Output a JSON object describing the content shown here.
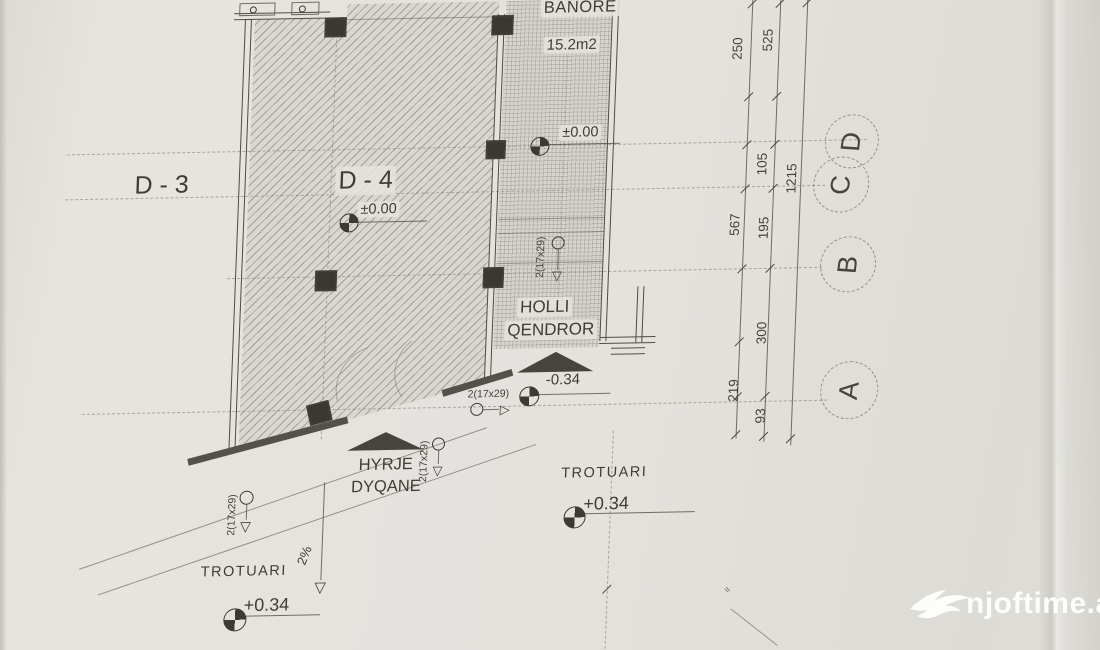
{
  "watermark": {
    "brand": "njoftime.al",
    "logo": "swallow-bird-logo"
  },
  "plan": {
    "units": {
      "d3": "D - 3",
      "d4": "D - 4"
    },
    "rooms": {
      "banore": "BANORE",
      "banore_area": "15.2m2",
      "hall_line1": "HOLLI",
      "hall_line2": "QENDROR"
    },
    "entrances": {
      "shop_line1": "HYRJE",
      "shop_line2": "DYQANE"
    },
    "sidewalk": {
      "label_left": "TROTUARI",
      "label_right": "TROTUARI",
      "slope": "2%"
    },
    "levels": {
      "d4": "±0.00",
      "hall": "±0.00",
      "entry": "-0.34",
      "sidewalk_left": "+0.34",
      "sidewalk_right": "+0.34"
    },
    "stair_notation": "2(17x29)",
    "arrows": {
      "down": "▽",
      "right": "▷"
    },
    "axes": {
      "a": "A",
      "b": "B",
      "c": "C",
      "d": "D"
    },
    "dimensions": {
      "col_inner": [
        "250",
        "567",
        "219"
      ],
      "col_middle": [
        "525",
        "105",
        "195",
        "300",
        "93"
      ],
      "total": "1215"
    },
    "colors": {
      "paper": "#e4e2dd",
      "ink": "#45433c",
      "watermark": "#ffffff"
    }
  }
}
